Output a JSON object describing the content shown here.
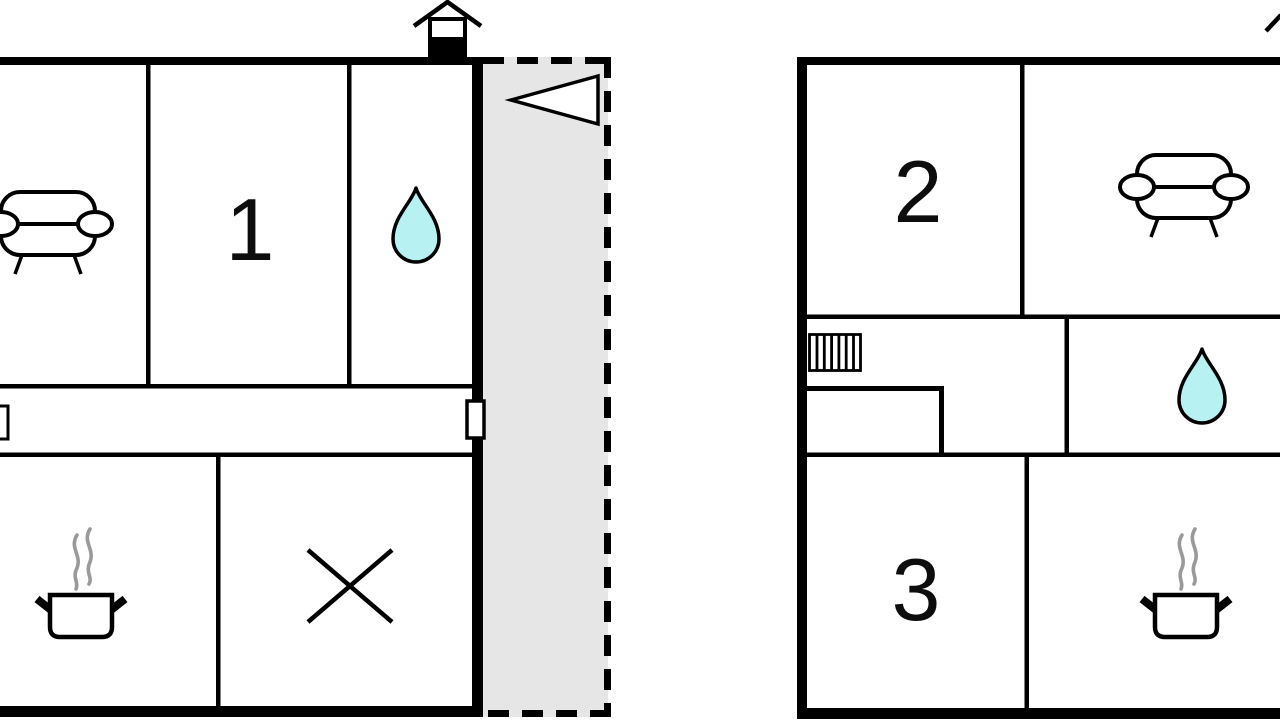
{
  "title": "Floor plan with two units",
  "colors": {
    "wall": "#000000",
    "water": "#b7f1f2",
    "terrace_fill": "#e6e6e6",
    "steam": "#9a9a9a",
    "icon_fill": "#ffffff"
  },
  "labels": {
    "room1": "1",
    "room2": "2",
    "room3": "3"
  },
  "units": {
    "left": {
      "rooms": [
        {
          "name": "living-room",
          "icon": "sofa-icon"
        },
        {
          "name": "bedroom-1",
          "label_ref": "room1"
        },
        {
          "name": "bathroom",
          "icon": "water-drop-icon"
        },
        {
          "name": "hallway",
          "doors": 2
        },
        {
          "name": "kitchen",
          "icon": "cooking-pot-icon"
        },
        {
          "name": "crossed-out-room",
          "icon": "x-mark-icon"
        }
      ],
      "features": [
        "chimney-house-symbol",
        "terrace-dashed",
        "entrance-arrow-left"
      ]
    },
    "right": {
      "rooms": [
        {
          "name": "bedroom-2",
          "label_ref": "room2"
        },
        {
          "name": "lounge",
          "icon": "sofa-icon"
        },
        {
          "name": "landing",
          "icon": "stairs-icon"
        },
        {
          "name": "bathroom",
          "icon": "water-drop-icon"
        },
        {
          "name": "bedroom-3",
          "label_ref": "room3"
        },
        {
          "name": "kitchen",
          "icon": "cooking-pot-icon"
        }
      ]
    }
  }
}
